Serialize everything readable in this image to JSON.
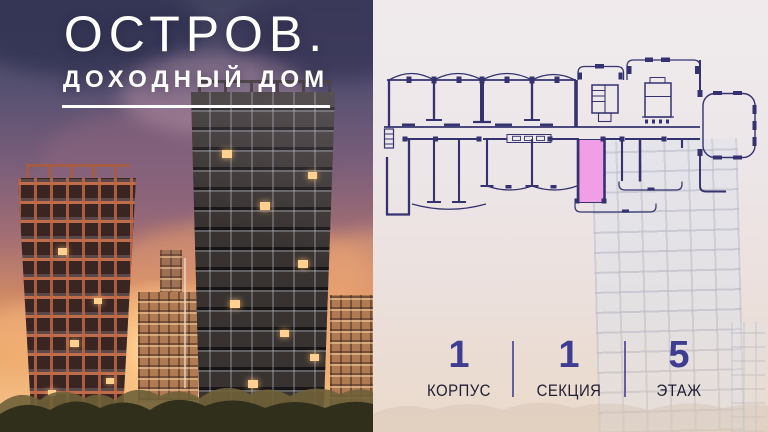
{
  "brand": {
    "title": "ОСТРОВ.",
    "subtitle": "ДОХОДНЫЙ ДОМ"
  },
  "floorplan": {
    "type": "apartment-floor-plan",
    "highlighted_unit_color": "#f09fe6",
    "line_color": "#34336f"
  },
  "stats": {
    "items": [
      {
        "value": "1",
        "label": "КОРПУС"
      },
      {
        "value": "1",
        "label": "СЕКЦИЯ"
      },
      {
        "value": "5",
        "label": "ЭТАЖ"
      }
    ]
  },
  "colors": {
    "accent-pink": "#f09fe6",
    "plan-line": "#34336f",
    "stat-number": "#3e3d92",
    "stat-label": "#1f1f33",
    "stat-divider": "#4a4896",
    "brand-text": "#ffffff"
  }
}
